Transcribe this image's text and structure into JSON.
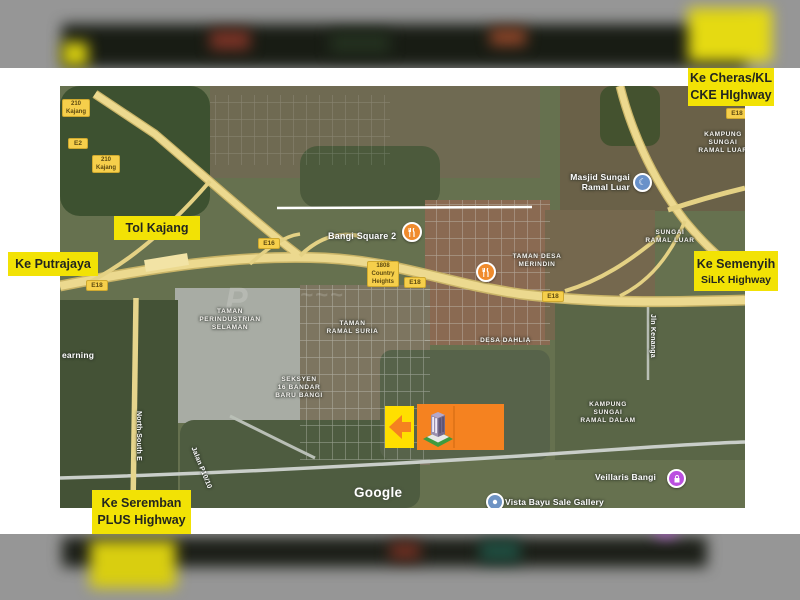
{
  "overlay_labels": {
    "cheras_l1": "Ke Cheras/KL",
    "cheras_l2": "CKE HIghway",
    "tol_kajang": "Tol Kajang",
    "putrajaya": "Ke Putrajaya",
    "semenyih_l1": "Ke Semenyih",
    "semenyih_l2": "SiLK Highway",
    "seremban_l1": "Ke Seremban",
    "seremban_l2": "PLUS Highway"
  },
  "map": {
    "attribution": "Google",
    "place_labels": {
      "kampung_luar_l1": "KAMPUNG",
      "kampung_luar_l2": "SUNGAI",
      "kampung_luar_l3": "RAMAL LUAR",
      "masjid_l1": "Masjid Sungai",
      "masjid_l2": "Ramal Luar",
      "sungai_ramal_l1": "SUNGAI",
      "sungai_ramal_l2": "RAMAL LUAR",
      "bangi_square": "Bangi Square 2",
      "merindin_l1": "TAMAN DESA",
      "merindin_l2": "MERINDIN",
      "country_l1": "1808",
      "country_l2": "Country",
      "country_l3": "Heights",
      "perindustrian_l1": "TAMAN",
      "perindustrian_l2": "PERINDUSTRIAN",
      "perindustrian_l3": "SELAMAN",
      "ramal_suria_l1": "TAMAN",
      "ramal_suria_l2": "RAMAL SURIA",
      "desa_dahlia": "DESA DAHLIA",
      "seksyen_l1": "SEKSYEN",
      "seksyen_l2": "16 BANDAR",
      "seksyen_l3": "BARU BANGI",
      "kampung_dalam_l1": "KAMPUNG",
      "kampung_dalam_l2": "SUNGAI",
      "kampung_dalam_l3": "RAMAL DALAM",
      "veillaris": "Veillaris Bangi",
      "vista_bayu": "Vista Bayu Sale Gallery",
      "earning": "earning",
      "north_south": "North-South E",
      "jln_kenanga": "Jln Kenanga",
      "jalan_p10": "Jalan P10/10"
    },
    "road_shields": {
      "kajang1_l1": "210",
      "kajang1_l2": "Kajang",
      "e2": "E2",
      "kajang2_l1": "210",
      "kajang2_l2": "Kajang",
      "e16": "E16",
      "e18_a": "E18",
      "e18_b": "E18",
      "e18_c": "E18",
      "e18_d": "E18"
    },
    "icons": {
      "mosque": "crescent-in-blue-circle",
      "restaurant": "fork-knife-in-orange-circle",
      "shopping": "bag-in-purple-circle",
      "gallery": "dot-in-blue-circle",
      "arrow_left": "orange-left-arrow",
      "building": "isometric-condo-building"
    },
    "colors": {
      "label_bg": "#f2e205",
      "label_text": "#23261f",
      "marker_orange": "#f58220",
      "marker_yellow": "#ffdf00",
      "shield_bg": "#f6cf4b",
      "highway": "#ecd98f",
      "mosque_poi": "#6991c9",
      "restaurant_poi": "#ef8b2d",
      "shopping_poi": "#bb4fe0",
      "gallery_poi": "#6f94c4"
    }
  }
}
